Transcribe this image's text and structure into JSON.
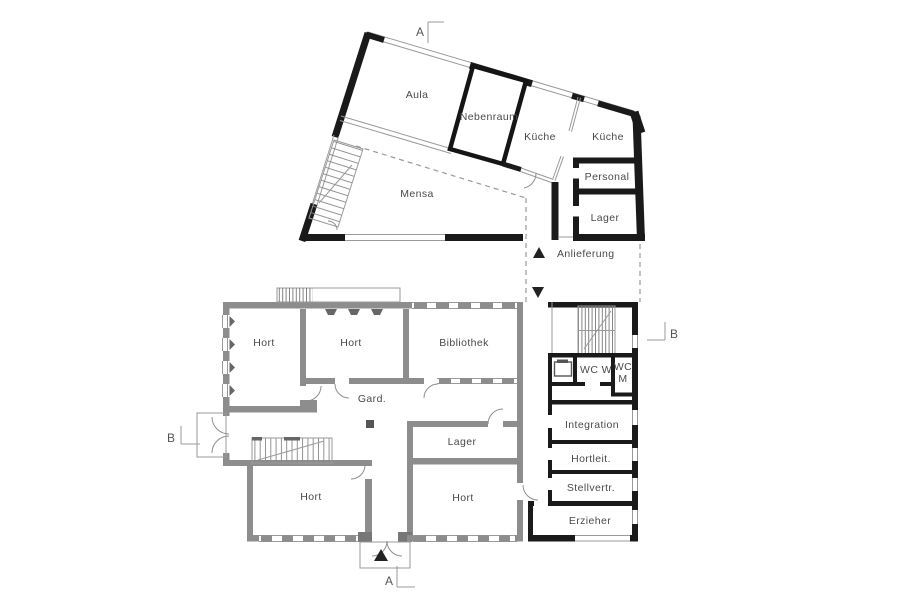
{
  "palette": {
    "wall_dark": "#1a1a1a",
    "wall_gray": "#8d8d8d",
    "thin_line": "#9a9a9a",
    "dashed_line": "#9a9a9a",
    "text": "#4a4a4a"
  },
  "section_markers": {
    "top": "A",
    "bottom": "A",
    "left": "B",
    "right": "B"
  },
  "corridor": {
    "label": "Anlieferung"
  },
  "mensa_building": {
    "rooms": {
      "aula": "Aula",
      "nebenraum": "Nebenraum",
      "kueche_west": "Küche",
      "kueche_ost": "Küche",
      "personal": "Personal",
      "lager": "Lager",
      "mensa": "Mensa"
    }
  },
  "hort_building": {
    "rooms": {
      "hort_nw": "Hort",
      "hort_n": "Hort",
      "bibliothek": "Bibliothek",
      "garderobe": "Gard.",
      "lager": "Lager",
      "hort_sw": "Hort",
      "hort_se": "Hort"
    }
  },
  "annex": {
    "rooms": {
      "wc_w": "WC W",
      "wc_m_line1": "WC",
      "wc_m_line2": "M",
      "integration": "Integration",
      "hortleitung": "Hortleit.",
      "stellvertretung": "Stellvertr.",
      "erzieher": "Erzieher"
    }
  }
}
